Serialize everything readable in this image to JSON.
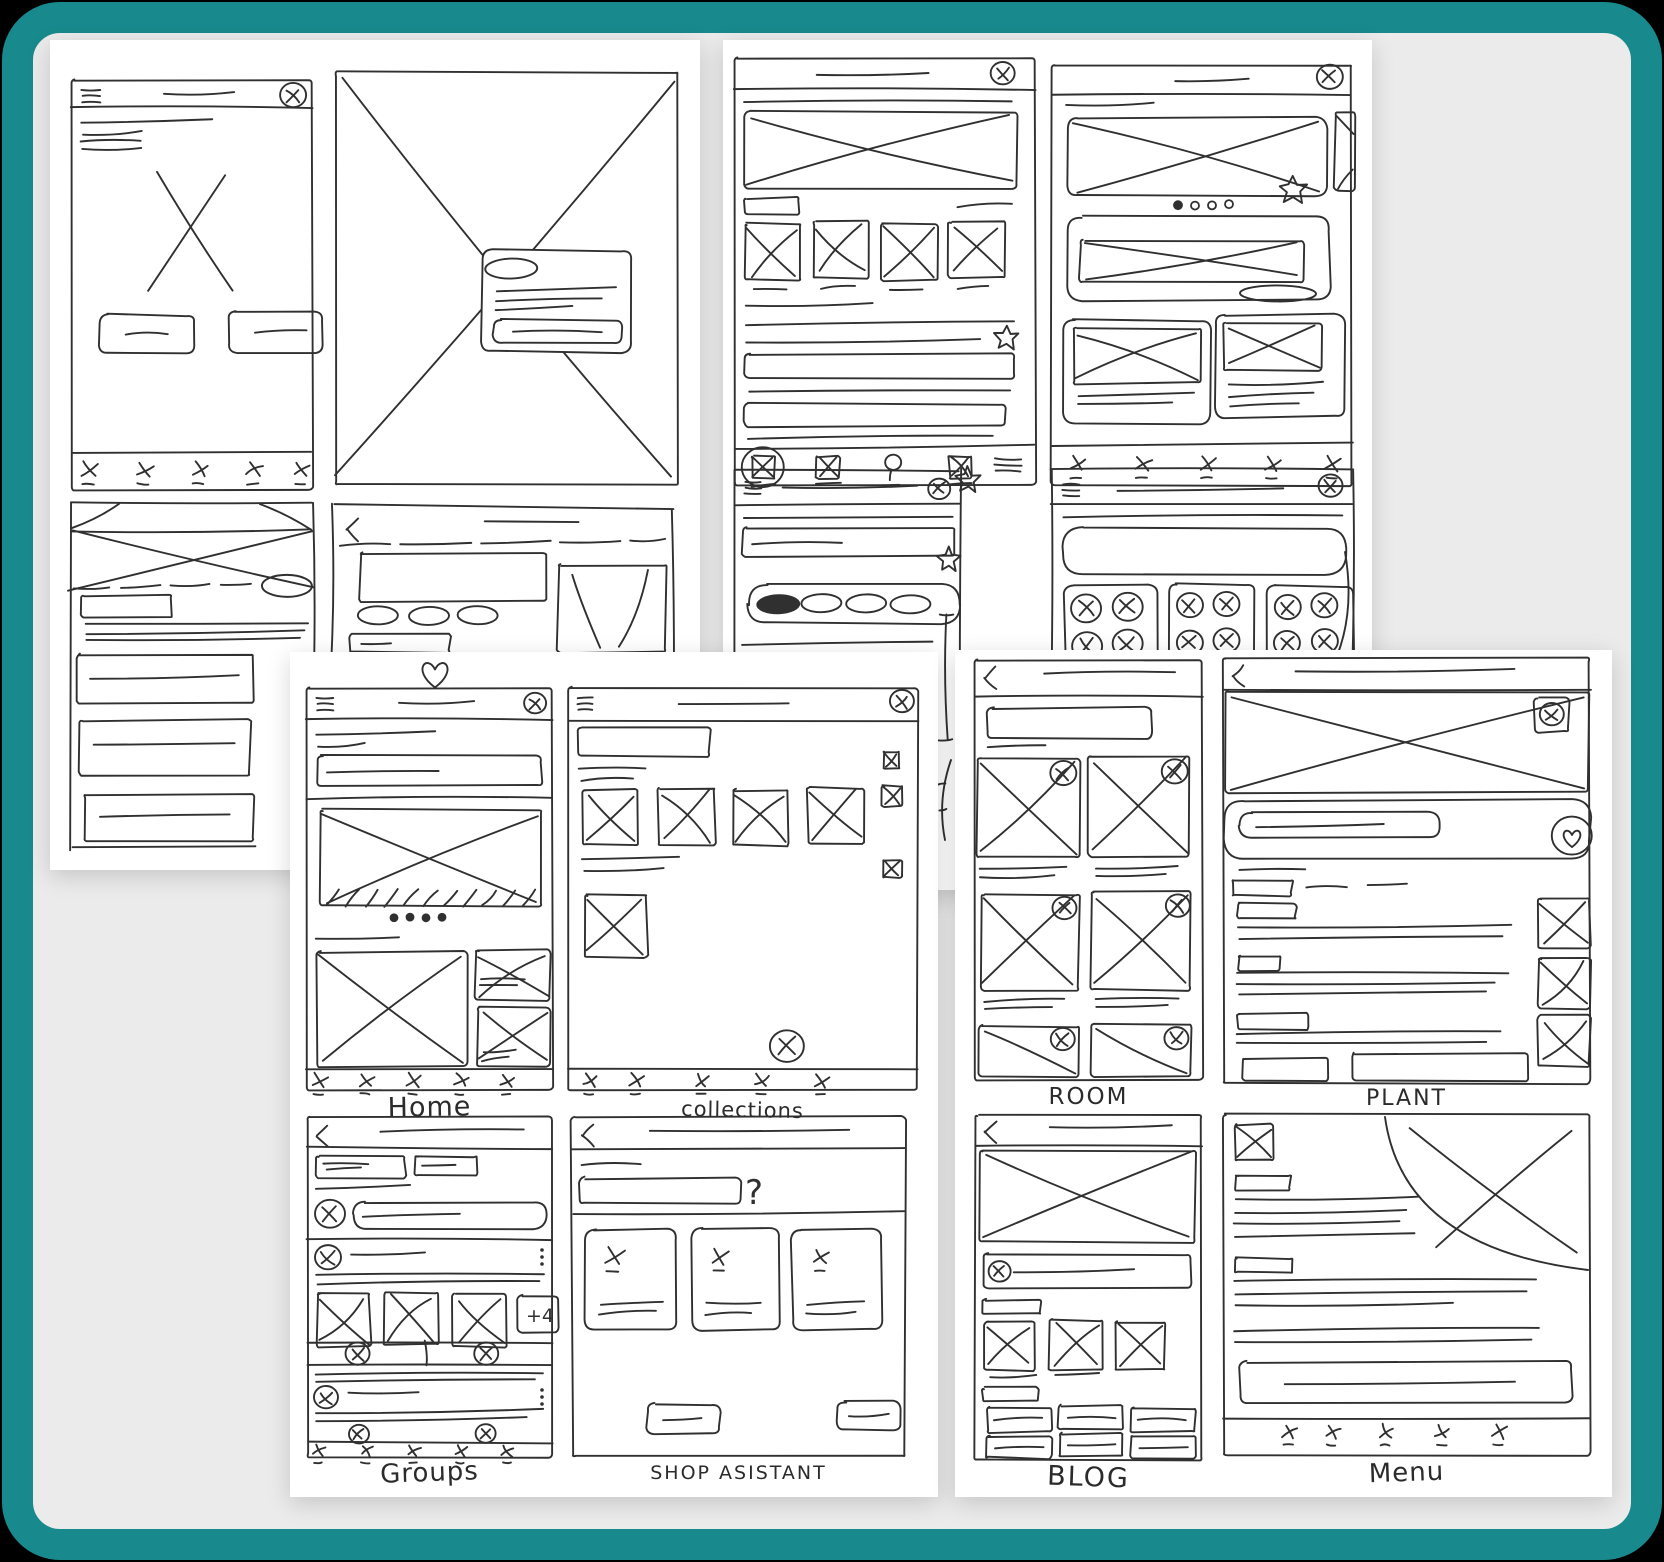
{
  "frame": {
    "outside_background": "#000000",
    "border_color": "#18898c",
    "mat_background": "#ebebeb",
    "paper_color": "#ffffff",
    "ink_color": "#303030"
  },
  "labels": {
    "home": "Home",
    "collections": "collections",
    "groups": "Groups",
    "shop_assistant": "SHOP ASISTANT",
    "room": "ROOM",
    "plant": "PLANT",
    "blog": "BLOG",
    "menu": "Menu"
  },
  "annotations": {
    "more_count_badge": "+4",
    "help_hint": "?"
  },
  "icons": [
    "hamburger-icon",
    "avatar-circle-x-icon",
    "image-placeholder-x-icon",
    "box-image-icon",
    "search-magnifier-icon",
    "back-chevron-icon",
    "star-doodle-icon",
    "heart-doodle-icon",
    "carousel-dots",
    "overflow-dots-icon"
  ]
}
